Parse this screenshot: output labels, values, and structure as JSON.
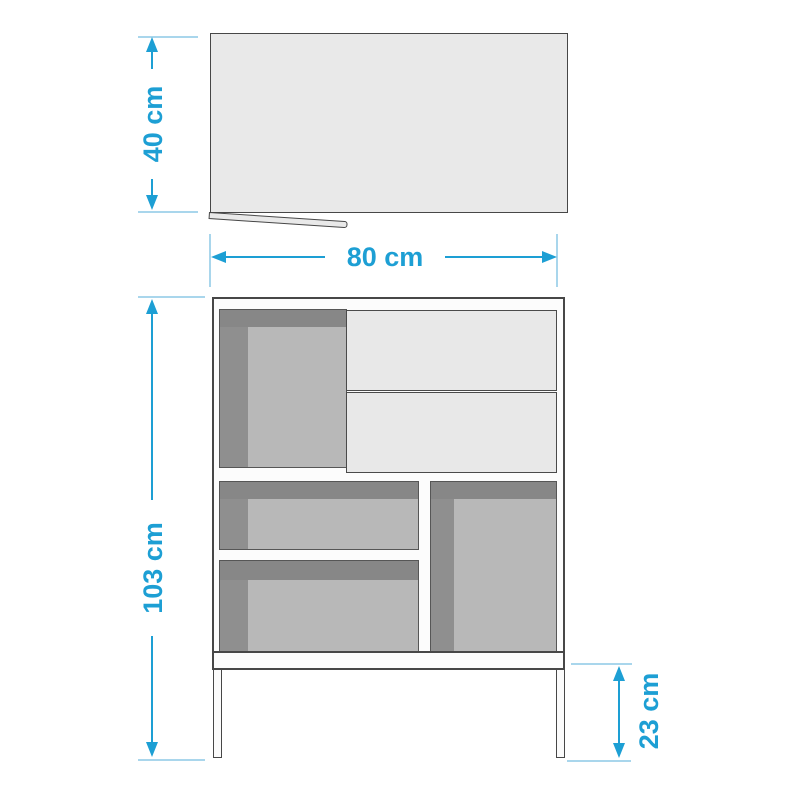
{
  "diagram": {
    "subject": "cabinet dimension drawing",
    "views": {
      "top_view": "cabinet top panel seen from above with open flap edge",
      "front_view": "cabinet front with drawers, open compartments and legs"
    },
    "dimensions": {
      "depth": {
        "label": "40 cm",
        "orientation": "vertical"
      },
      "width": {
        "label": "80 cm",
        "orientation": "horizontal"
      },
      "height": {
        "label": "103 cm",
        "orientation": "vertical"
      },
      "leg_height": {
        "label": "23 cm",
        "orientation": "vertical"
      }
    },
    "colors": {
      "accent_blue": "#1d9fd4",
      "tick_blue": "#a9d6ec",
      "outline": "#474747",
      "board_white": "#fbfbfb",
      "panel_light_gray": "#e8e8e8",
      "compartment_back_gray": "#b8b8b8",
      "compartment_shadow_gray": "#878787"
    }
  }
}
